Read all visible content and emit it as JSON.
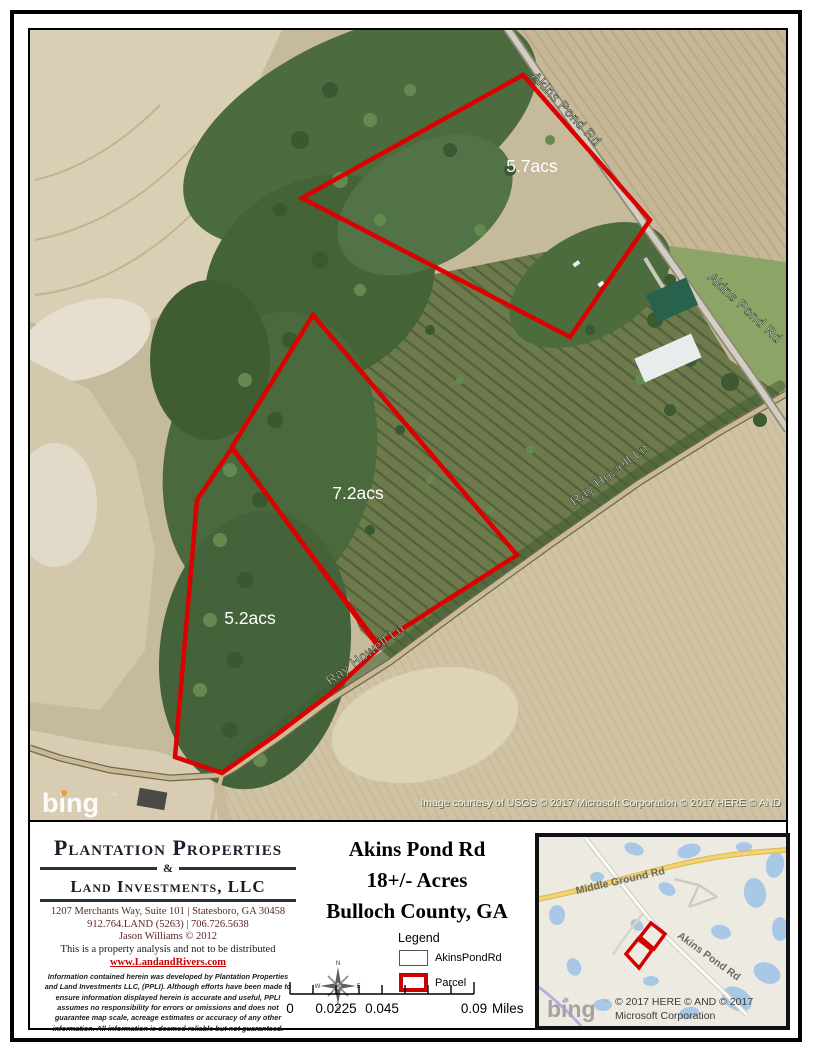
{
  "map": {
    "acreage": [
      "5.7acs",
      "7.2acs",
      "5.2acs"
    ],
    "roads": {
      "akins": "Akins Pond Rd",
      "ray": "Ray Howell Ln"
    },
    "bing": "bing",
    "bing_tm": "™",
    "attribution": "Image courtesy of USGS © 2017 Microsoft Corporation © 2017 HERE © AND"
  },
  "company": {
    "name1": "Plantation Properties",
    "amp": "&",
    "name2": "Land Investments, LLC",
    "address": "1207 Merchants Way, Suite 101 | Statesboro, GA 30458",
    "phone": "912.764.LAND (5263) | 706.726.5638",
    "credit": "Jason Williams © 2012",
    "note": "This is a property analysis and not to be distributed",
    "website": "www.LandandRivers.com",
    "disclaimer": "Information contained herein was developed by Plantation Properties and Land Investments LLC, (PPLI).  Although efforts have been made to ensure information displayed herein is accurate and useful, PPLI assumes no responsibility for errors or omissions and does not guarantee map scale, acreage estimates or accuracy of any other information.  All information is deemed reliable but not guaranteed."
  },
  "title": {
    "line1": "Akins Pond Rd",
    "line2": "18+/- Acres",
    "line3": "Bulloch County, GA"
  },
  "legend": {
    "title": "Legend",
    "items": [
      {
        "label": "AkinsPondRd"
      },
      {
        "label": "Parcel"
      }
    ]
  },
  "compass": {
    "n": "N",
    "e": "E",
    "s": "S",
    "w": "W"
  },
  "scalebar": {
    "t0": "0",
    "t1": "0.0225",
    "t2": "0.045",
    "t3": "0.09",
    "unit": "Miles"
  },
  "inset": {
    "road1": "Middle Ground Rd",
    "road2": "Akins Pond Rd",
    "bing": "bing",
    "tm": "™",
    "copy1": "© 2017 HERE © AND © 2017",
    "copy2": "Microsoft Corporation"
  },
  "colors": {
    "parcel_outline": "#dd0000",
    "link_red": "#c40000",
    "water_blue": "#a9c7e6",
    "road_yellow": "#f2d377",
    "bing_orange": "#f0a030"
  }
}
